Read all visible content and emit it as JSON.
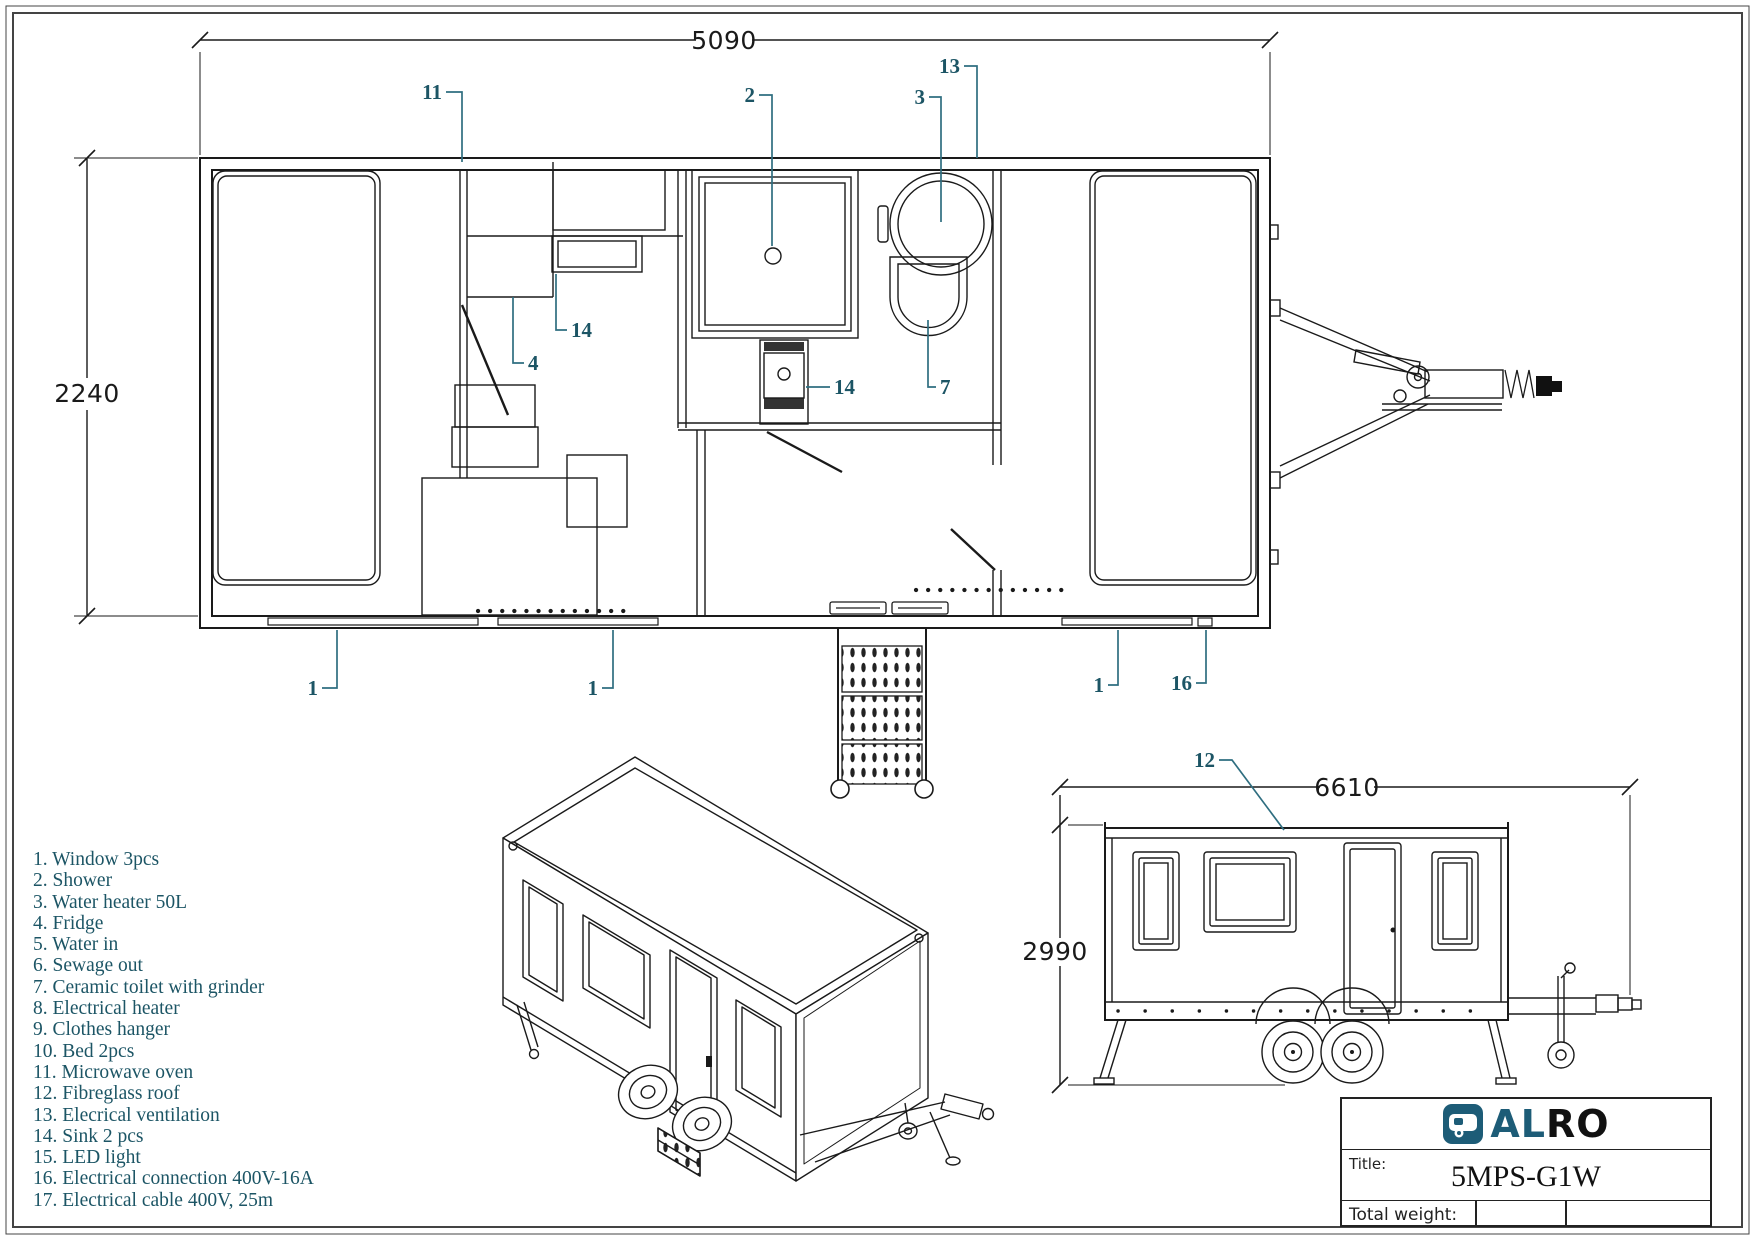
{
  "colors": {
    "line": "#1a1a1a",
    "callout": "#1c5565",
    "leader": "#2f6e80",
    "logo_teal": "#1d5c77"
  },
  "plan_view": {
    "dim_width": "5090",
    "dim_height": "2240",
    "callouts": {
      "microwave": "11",
      "shower": "2",
      "water_heater": "3",
      "ventilation": "13",
      "sink_kitchen": "14",
      "fridge": "4",
      "sink_bath": "14",
      "toilet": "7",
      "window_left": "1",
      "window_mid": "1",
      "window_right": "1",
      "connection": "16"
    }
  },
  "side_view": {
    "dim_length": "6610",
    "dim_height": "2990",
    "callouts": {
      "roof": "12"
    }
  },
  "parts_list": {
    "items": [
      "1. Window 3pcs",
      "2. Shower",
      "3. Water heater 50L",
      "4. Fridge",
      "5. Water in",
      "6. Sewage out",
      "7. Ceramic toilet with grinder",
      "8. Electrical heater",
      "9. Clothes hanger",
      "10. Bed 2pcs",
      "11. Microwave oven",
      "12. Fibreglass roof",
      "13. Elecrical ventilation",
      "14. Sink 2 pcs",
      "15. LED light",
      "16. Electrical connection 400V-16A",
      "17. Electrical cable 400V, 25m"
    ]
  },
  "title_block": {
    "logo_al": "AL",
    "logo_ro": "RO",
    "title_label": "Title:",
    "title_value": "5MPS-G1W",
    "weight_label": "Total weight:"
  }
}
